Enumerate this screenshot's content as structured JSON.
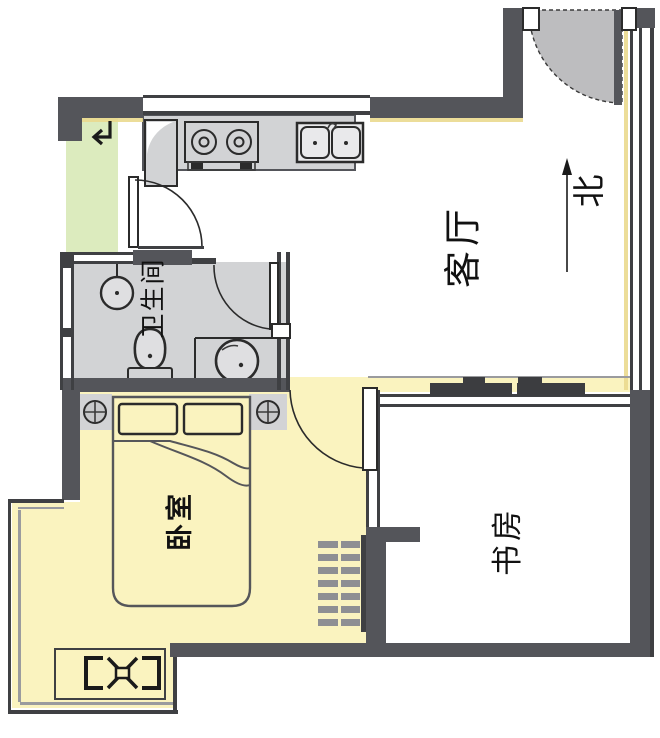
{
  "rooms": {
    "living_room": {
      "label": "客厅"
    },
    "bathroom": {
      "label": "卫生间"
    },
    "bedroom": {
      "label": "卧室"
    },
    "study": {
      "label": "书房"
    }
  },
  "compass": {
    "north_label": "北"
  },
  "colors": {
    "wall": "#54555a",
    "room_gray": "#d2d3d5",
    "room_yellow": "#faf3bf",
    "room_green": "#dcebbe",
    "door_gray": "#bdbdbf",
    "accent_shadow": "#ead98e",
    "background": "#ffffff"
  }
}
